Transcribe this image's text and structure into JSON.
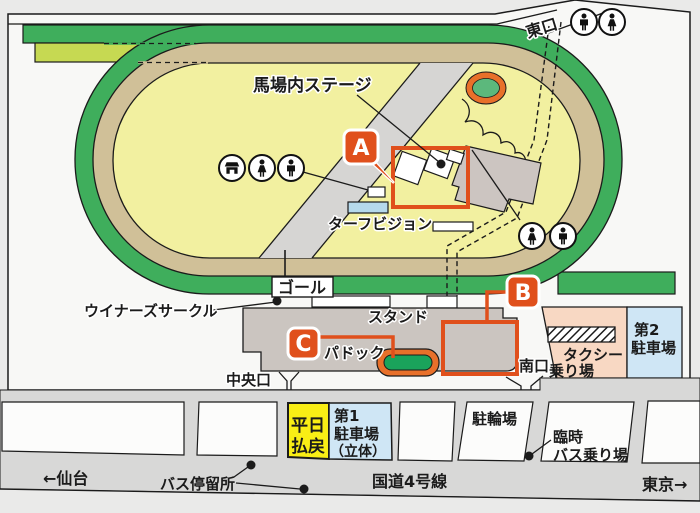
{
  "labels": {
    "stage": "馬場内ステージ",
    "turf_vision": "ターフビジョン",
    "goal": "ゴール",
    "stand": "スタンド",
    "paddock": "パドック",
    "winners_circle": "ウイナーズサークル",
    "central_gate": "中央口",
    "south_gate": "南口",
    "east_gate": "東口"
  },
  "markers": {
    "a": "A",
    "b": "B",
    "c": "C"
  },
  "facilities": {
    "taxi": {
      "line1": "タクシー",
      "line2": "乗り場"
    },
    "parking2": {
      "line1": "第2",
      "line2": "駐車場"
    },
    "weekday_refund": {
      "line1": "平日",
      "line2": "払戻"
    },
    "parking1": {
      "line1": "第1",
      "line2": "駐車場",
      "line3": "（立体）"
    },
    "bicycle_parking": "駐輪場",
    "temp_bus": {
      "line1": "臨時",
      "line2": "バス乗り場"
    }
  },
  "roads": {
    "sendai": "←仙台",
    "bus_stop": "バス停留所",
    "route4": "国道4号線",
    "tokyo": "東京→"
  },
  "icons": {
    "east_gate": [
      "mens-restroom",
      "womens-restroom"
    ],
    "infield_left": [
      "shop",
      "womens-restroom",
      "mens-restroom"
    ],
    "infield_right": [
      "womens-restroom",
      "mens-restroom"
    ]
  },
  "colors": {
    "turf_green": "#3fae5c",
    "dirt_tan": "#d0c098",
    "infield_yellow": "#f2f0a0",
    "chute_yellow_green": "#c6d952",
    "highlight_orange": "#e0501c",
    "paddock_orange": "#e8702a",
    "paddock_green": "#1aa35b",
    "pond_green": "#5cb87c",
    "stand_gray": "#cbc5c0",
    "taxi_pink": "#f8d8c3",
    "parking_blue": "#cfe6f5",
    "refund_yellow": "#f9ee15",
    "turf_vision_blue": "#b5d9ec",
    "road_gray": "#d8d8d7",
    "background": "#eaeae9"
  }
}
